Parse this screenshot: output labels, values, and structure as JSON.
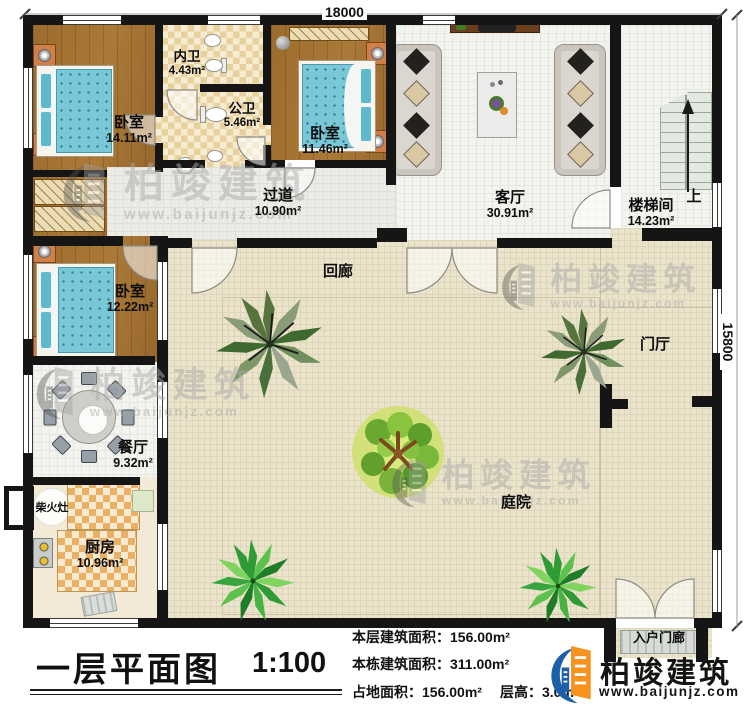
{
  "dimensions": {
    "top_width": "18000",
    "right_height": "15800"
  },
  "rooms": [
    {
      "id": "bedroom-1",
      "name": "卧室",
      "area": "14.11m²"
    },
    {
      "id": "inner-bath",
      "name": "内卫",
      "area": "4.43m²"
    },
    {
      "id": "public-bath",
      "name": "公卫",
      "area": "5.46m²"
    },
    {
      "id": "bedroom-2",
      "name": "卧室",
      "area": "11.46m²"
    },
    {
      "id": "living-room",
      "name": "客厅",
      "area": "30.91m²"
    },
    {
      "id": "stair-hall",
      "name": "楼梯间",
      "area": "14.23m²"
    },
    {
      "id": "hallway",
      "name": "过道",
      "area": "10.90m²"
    },
    {
      "id": "cloister",
      "name": "回廊",
      "area": ""
    },
    {
      "id": "bedroom-3",
      "name": "卧室",
      "area": "12.22m²"
    },
    {
      "id": "dining-room",
      "name": "餐厅",
      "area": "9.32m²"
    },
    {
      "id": "wood-stove",
      "name": "柴火灶",
      "area": ""
    },
    {
      "id": "kitchen",
      "name": "厨房",
      "area": "10.96m²"
    },
    {
      "id": "courtyard",
      "name": "庭院",
      "area": ""
    },
    {
      "id": "foyer",
      "name": "门厅",
      "area": ""
    },
    {
      "id": "entry-porch",
      "name": "入户门廊",
      "area": ""
    },
    {
      "id": "stairs-up",
      "name": "上",
      "area": ""
    }
  ],
  "title_block": {
    "title": "一层平面图",
    "scale": "1:100"
  },
  "info": {
    "floor_area": "本层建筑面积：156.00m²",
    "building_area": "本栋建筑面积：311.00m²",
    "land_area": "占地面积：156.00m²",
    "floor_height": "层高：3.0m"
  },
  "brand": {
    "name": "柏竣建筑",
    "url": "www.baijunjz.com"
  },
  "watermark": {
    "name": "柏竣建筑",
    "url": "www.baijunjz.com"
  },
  "colors": {
    "wall": "#151515",
    "wood_floor": "#a3742f",
    "tile_beige": "#ebe4cb",
    "mattress": "#79c8d8",
    "brand_orange": "#f6921e",
    "brand_blue": "#1d5fa8"
  }
}
